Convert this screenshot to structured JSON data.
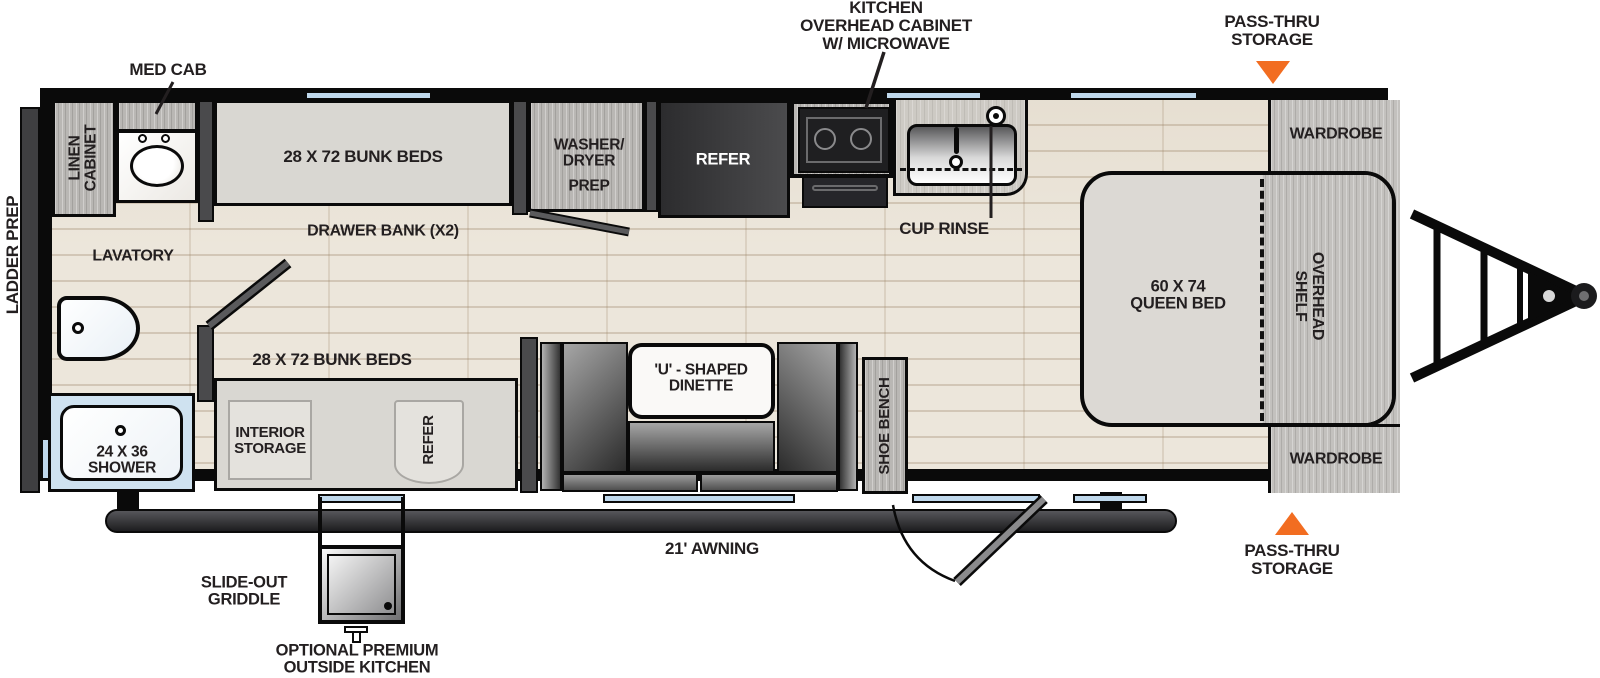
{
  "diagram_type": "travel-trailer floorplan",
  "colors": {
    "accent_orange": "#F26D21",
    "window_blue": "#BFD8EC",
    "wall_black": "#0A0A0A",
    "floor_wood": "#ECE6DB",
    "cabinet_gray": "#B9B7B4",
    "bed_gray": "#DCD9D4",
    "unit_dark": "#3F3F41",
    "text_dark": "#231F20"
  },
  "callouts": {
    "med_cab": "MED CAB",
    "kitchen_overhead": [
      "KITCHEN",
      "OVERHEAD CABINET",
      "W/ MICROWAVE"
    ],
    "pass_thru_top": [
      "PASS-THRU",
      "STORAGE"
    ],
    "pass_thru_bottom": [
      "PASS-THRU",
      "STORAGE"
    ],
    "ladder_prep": "LADDER PREP",
    "cup_rinse": "CUP RINSE",
    "drawer_bank": "DRAWER BANK (X2)",
    "lavatory": "LAVATORY",
    "bunk_bottom": "28 X 72 BUNK BEDS",
    "awning": "21' AWNING",
    "slide_out_griddle": [
      "SLIDE-OUT",
      "GRIDDLE"
    ],
    "outside_kitchen": [
      "OPTIONAL PREMIUM",
      "OUTSIDE KITCHEN"
    ]
  },
  "fixtures": {
    "linen_cabinet": [
      "LINEN",
      "CABINET"
    ],
    "bunk_top": "28 X 72 BUNK BEDS",
    "washer_dryer": [
      "WASHER/",
      "DRYER",
      "PREP"
    ],
    "refer_top": "REFER",
    "wardrobe_top": "WARDROBE",
    "queen_bed": [
      "60 X 74",
      "QUEEN BED"
    ],
    "overhead_shelf": [
      "OVERHEAD",
      "SHELF"
    ],
    "wardrobe_bottom": "WARDROBE",
    "interior_storage": [
      "INTERIOR",
      "STORAGE"
    ],
    "refer_bottom": "REFER",
    "dinette": [
      "'U' - SHAPED",
      "DINETTE"
    ],
    "shoe_bench": "SHOE BENCH",
    "shower": [
      "24 X 36",
      "SHOWER"
    ]
  }
}
